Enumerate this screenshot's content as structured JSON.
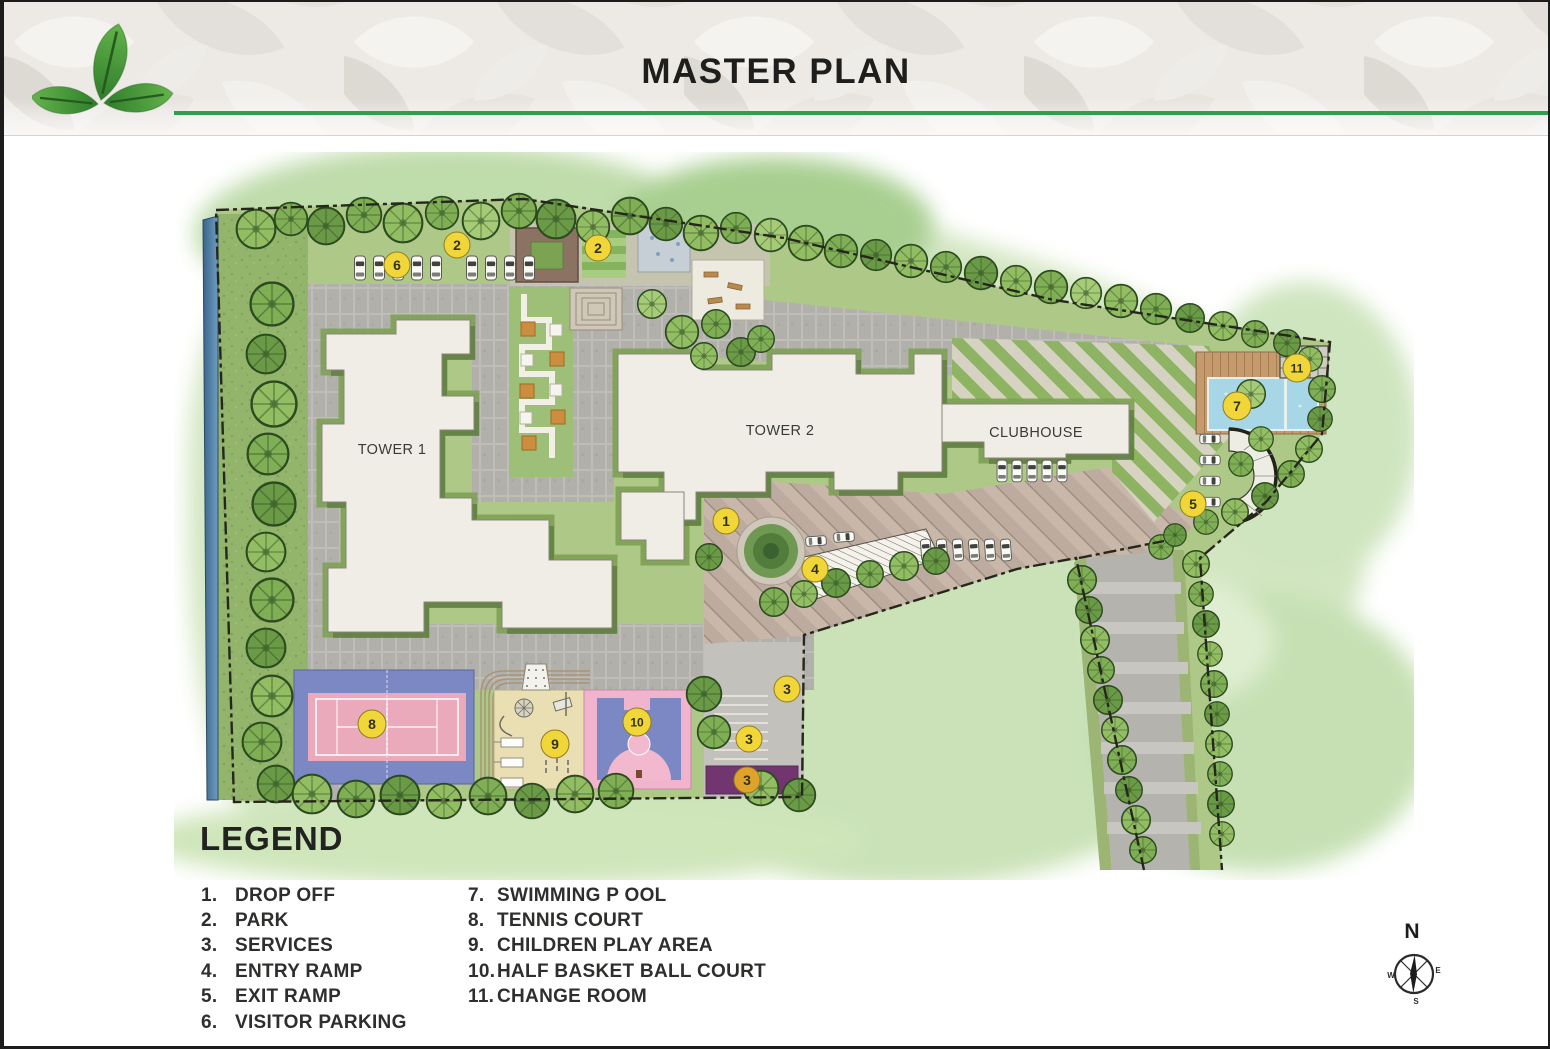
{
  "header": {
    "title": "MASTER PLAN"
  },
  "plan": {
    "building_labels": {
      "tower1": "TOWER 1",
      "tower2": "TOWER 2",
      "clubhouse": "CLUBHOUSE"
    },
    "markers": [
      {
        "number": "1"
      },
      {
        "number": "2"
      },
      {
        "number": "2"
      },
      {
        "number": "3"
      },
      {
        "number": "3"
      },
      {
        "number": "3"
      },
      {
        "number": "4"
      },
      {
        "number": "5"
      },
      {
        "number": "6"
      },
      {
        "number": "7"
      },
      {
        "number": "8"
      },
      {
        "number": "9"
      },
      {
        "number": "10"
      },
      {
        "number": "11"
      }
    ]
  },
  "legend": {
    "heading": "LEGEND",
    "items": [
      {
        "number": "1.",
        "label": "DROP OFF"
      },
      {
        "number": "2.",
        "label": "PARK"
      },
      {
        "number": "3.",
        "label": "SERVICES"
      },
      {
        "number": "4.",
        "label": "ENTRY RAMP"
      },
      {
        "number": "5.",
        "label": "EXIT RAMP"
      },
      {
        "number": "6.",
        "label": "VISITOR PARKING"
      },
      {
        "number": "7.",
        "label": "SWIMMING P OOL"
      },
      {
        "number": "8.",
        "label": "TENNIS COURT"
      },
      {
        "number": "9.",
        "label": "CHILDREN PLAY AREA"
      },
      {
        "number": "10.",
        "label": "HALF BASKET BALL COURT"
      },
      {
        "number": "11.",
        "label": "CHANGE ROOM"
      }
    ]
  },
  "compass": {
    "north": "N",
    "west": "W",
    "east": "E",
    "south": "S"
  },
  "colors": {
    "accent": "#2f9e4f",
    "marker-yellow": "#f1d63a",
    "marker-amber": "#dfa32c",
    "water": "#4d7fa6",
    "pool": "#a7d6e6",
    "court-blue": "#7c88c4",
    "court-pink": "#eaaabc",
    "basket-pink": "#f0b4cc",
    "play-cream": "#e9dfb2",
    "purple": "#73356f"
  }
}
